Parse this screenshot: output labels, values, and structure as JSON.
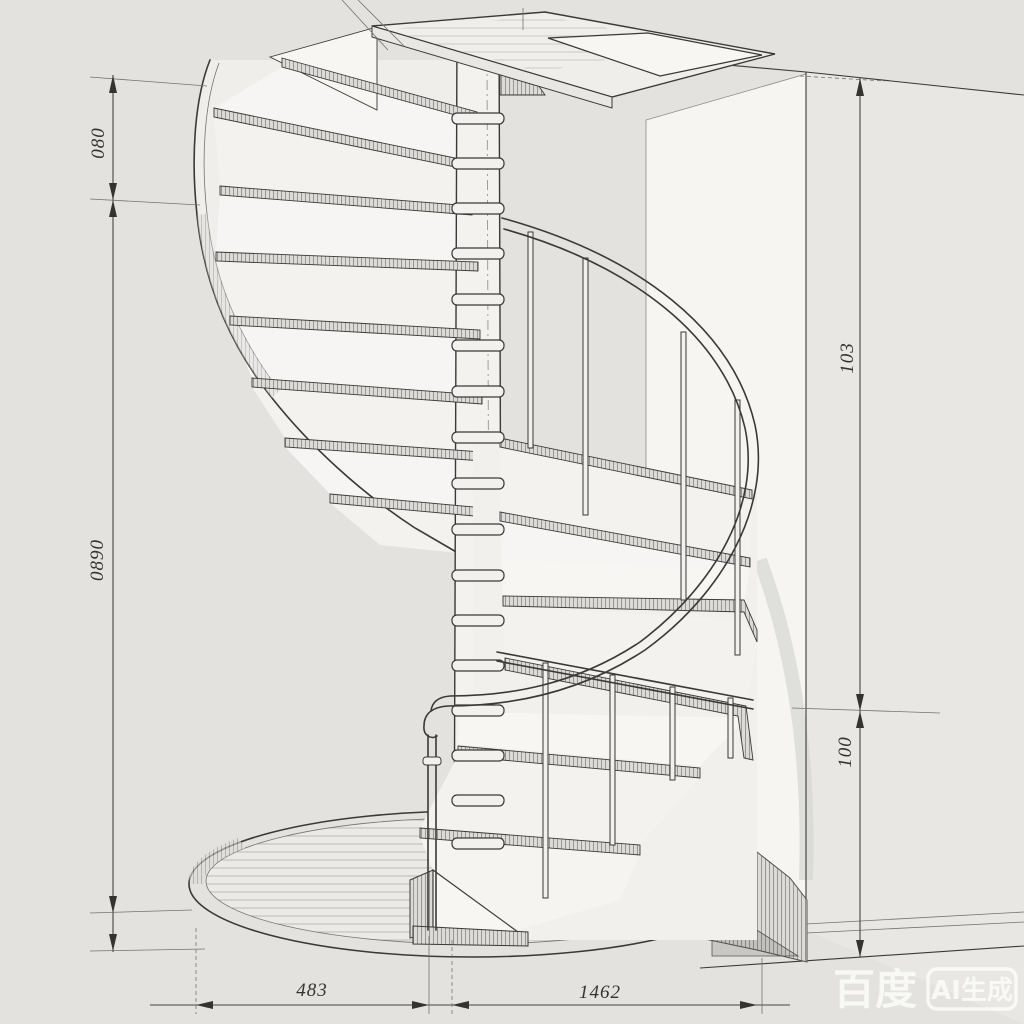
{
  "drawing": {
    "subject": "spiral staircase technical drawing",
    "view": "perspective line drawing with dimension lines"
  },
  "dimensions": {
    "left_top": "080",
    "left_bottom": "0890",
    "right_upper": "103",
    "right_lower": "100",
    "bottom_left": "483",
    "bottom_right": "1462"
  },
  "watermark": {
    "brand": "百度",
    "badge": "AI生成"
  },
  "colors": {
    "paper": "#e3e2df",
    "wall_highlight": "#f6f5f2",
    "ink": "#3a3937",
    "watermark": "#fcfcf9"
  }
}
